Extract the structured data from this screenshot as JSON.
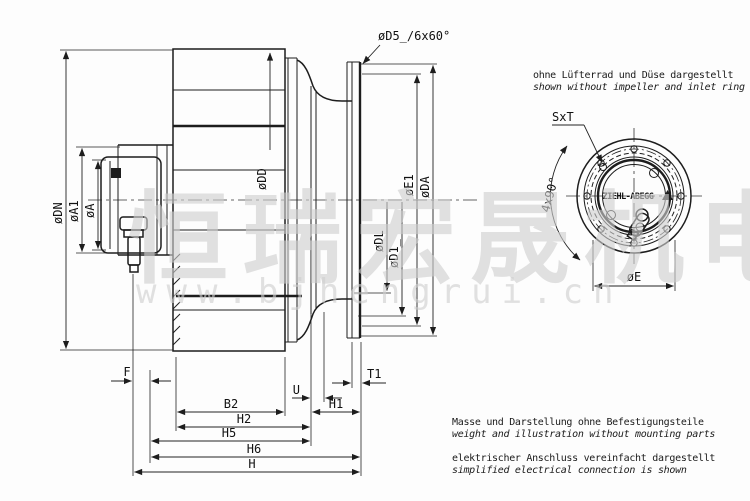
{
  "page": {
    "background": "#fdfdfd",
    "line_color": "#1d1d1d",
    "watermark_color": "#cfcfcf"
  },
  "notes": {
    "top_line1": "ohne Lüfterrad und Düse dargestellt",
    "top_line2": "shown without impeller and inlet ring",
    "weight_line1": "Masse und Darstellung ohne Befestigungsteile",
    "weight_line2": "weight and illustration without mounting parts",
    "electrical_line1": "elektrischer Anschluss vereinfacht dargestellt",
    "electrical_line2": "simplified electrical connection is shown"
  },
  "labels": {
    "d5": "øD5_/6x60°",
    "dn": "øDN",
    "a1": "øA1",
    "a": "øA",
    "dd": "øDD",
    "dl": "øDL",
    "d1": "øD1_",
    "e1": "øE1",
    "da": "øDA",
    "f": "F",
    "t1": "T1",
    "u": "U",
    "b2": "B2",
    "h1": "H1",
    "h2": "H2",
    "h5": "H5",
    "h6": "H6",
    "h": "H",
    "sxt": "SxT",
    "four_x_90": "4x90°",
    "e": "øE",
    "logo": "ZIEHL-ABEGG"
  },
  "watermark": {
    "cjk": "恒瑞宏晟机电",
    "url": "www.bjhengrui.cn"
  }
}
